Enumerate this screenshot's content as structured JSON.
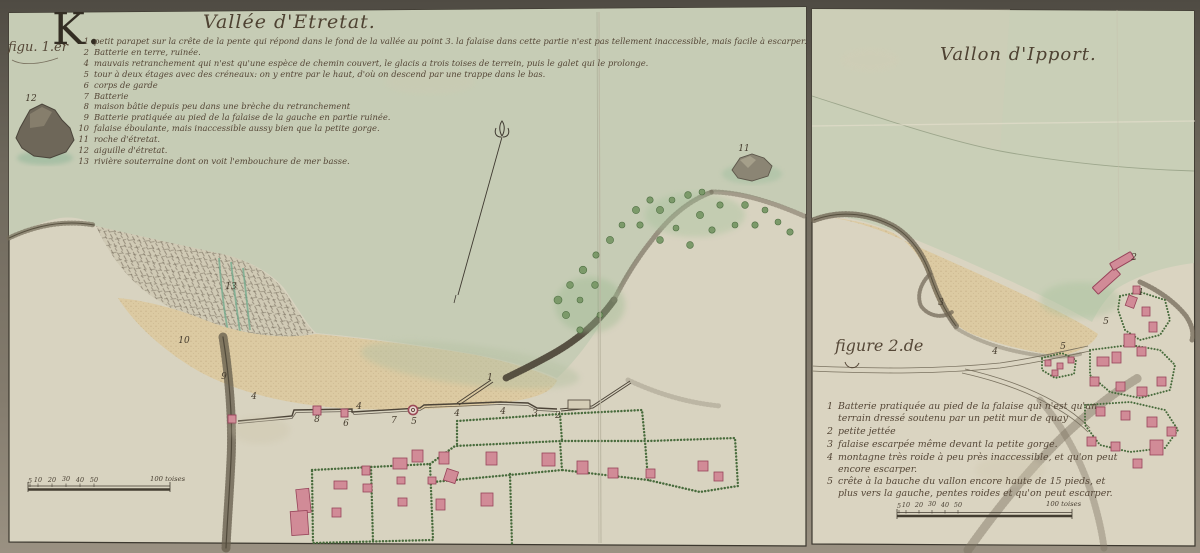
{
  "frame": {
    "big_letter": "K.",
    "fig1_label": "figu. 1.er"
  },
  "left_map": {
    "title": "Vallée d'Etretat.",
    "legend": [
      {
        "n": "1",
        "text": "petit parapet sur la crête de la pente qui répond dans le fond de la vallée au point 3. la falaise dans cette partie n'est pas tellement inaccessible, mais facile à escarper."
      },
      {
        "n": "2",
        "text": "Batterie en terre, ruinée."
      },
      {
        "n": "4",
        "text": "mauvais retranchement qui n'est qu'une espèce de chemin couvert, le glacis a trois toises de terrein, puis le galet qui le prolonge."
      },
      {
        "n": "5",
        "text": "tour à deux étages avec des créneaux: on y entre par le haut, d'où on descend par une trappe dans le bas."
      },
      {
        "n": "6",
        "text": "corps de garde"
      },
      {
        "n": "7",
        "text": "Batterie"
      },
      {
        "n": "8",
        "text": "maison bâtie depuis peu dans une brèche du retranchement"
      },
      {
        "n": "9",
        "text": "Batterie pratiquée au pied de la falaise de la gauche en partie ruinée."
      },
      {
        "n": "10",
        "text": "falaise éboulante, mais inaccessible aussy bien que la petite gorge."
      },
      {
        "n": "11",
        "text": "roche d'étretat."
      },
      {
        "n": "12",
        "text": "aiguille d'étretat."
      },
      {
        "n": "13",
        "text": "rivière souterraine dont on voit l'embouchure de mer basse."
      }
    ],
    "points": [
      {
        "n": "12",
        "x": 31,
        "y": 99
      },
      {
        "n": "11",
        "x": 744,
        "y": 149
      },
      {
        "n": "13",
        "x": 231,
        "y": 287
      },
      {
        "n": "10",
        "x": 184,
        "y": 341
      },
      {
        "n": "9",
        "x": 224,
        "y": 377
      },
      {
        "n": "4",
        "x": 254,
        "y": 397
      },
      {
        "n": "8",
        "x": 317,
        "y": 420
      },
      {
        "n": "6",
        "x": 346,
        "y": 424
      },
      {
        "n": "4",
        "x": 359,
        "y": 407
      },
      {
        "n": "7",
        "x": 394,
        "y": 421
      },
      {
        "n": "5",
        "x": 414,
        "y": 422
      },
      {
        "n": "4",
        "x": 457,
        "y": 414
      },
      {
        "n": "4",
        "x": 503,
        "y": 412
      },
      {
        "n": "3",
        "x": 535,
        "y": 414
      },
      {
        "n": "2",
        "x": 558,
        "y": 416
      },
      {
        "n": "1",
        "x": 490,
        "y": 378
      }
    ],
    "scale": {
      "ticks": [
        "5",
        "10",
        "20",
        "30",
        "40",
        "50"
      ],
      "end_label": "100 toises"
    }
  },
  "right_map": {
    "title": "Vallon d'Ipport.",
    "figure_label": "figure 2.de",
    "legend": [
      {
        "n": "1",
        "text": "Batterie pratiquée au pied de la falaise qui n'est qu'un terrain dressé soutenu par un petit mur de quay"
      },
      {
        "n": "2",
        "text": "petite jettée"
      },
      {
        "n": "3",
        "text": "falaise escarpée même devant la petite gorge."
      },
      {
        "n": "4",
        "text": "montagne très roide à peu près inaccessible, et qu'on peut encore escarper."
      },
      {
        "n": "5",
        "text": "crête à la bauche du vallon encore haute de 15 pieds, et plus vers la gauche, pentes roides et qu'on peut escarper."
      }
    ],
    "points": [
      {
        "n": "2",
        "x": 1134,
        "y": 258
      },
      {
        "n": "3",
        "x": 941,
        "y": 303
      },
      {
        "n": "4",
        "x": 995,
        "y": 352
      },
      {
        "n": "5",
        "x": 1106,
        "y": 322
      },
      {
        "n": "1",
        "x": 1141,
        "y": 293
      },
      {
        "n": "5",
        "x": 1063,
        "y": 347
      }
    ],
    "scale": {
      "ticks": [
        "5",
        "10",
        "20",
        "30",
        "40",
        "50"
      ],
      "end_label": "100 toises"
    }
  },
  "colors": {
    "mount": "#6e685c",
    "paper": "#d8d3c0",
    "sea": "#c6ccb5",
    "sand": "#dccaa2",
    "building_pink": "#d18b97",
    "building_outline": "#97445a",
    "hedge_green": "#486b3c",
    "ink": "#554737"
  }
}
